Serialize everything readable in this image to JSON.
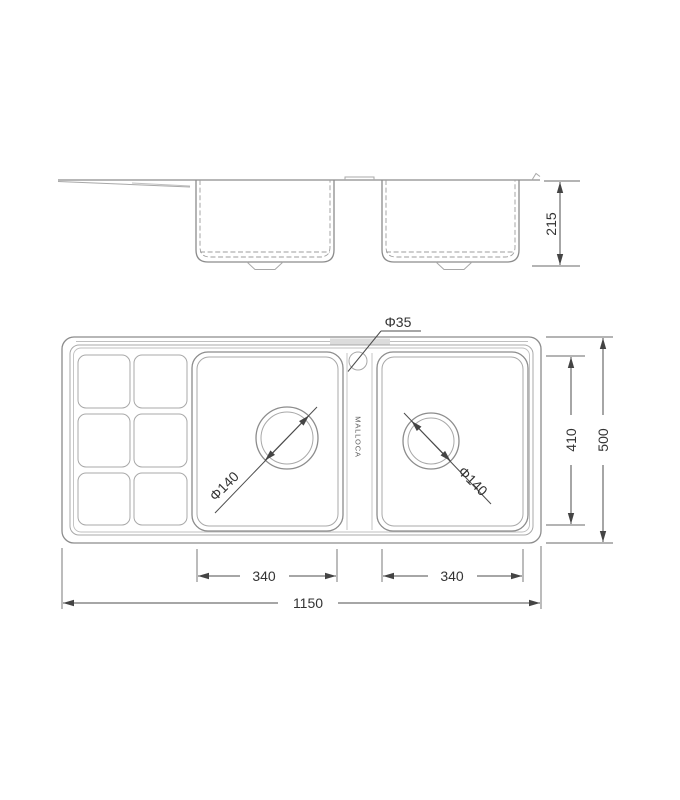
{
  "drawing": {
    "brand_label": "MALLOCA",
    "dims": {
      "bowl_depth": "215",
      "faucet_hole": "Φ35",
      "left_drain": "Φ140",
      "right_drain": "Φ140",
      "bowl_length": "410",
      "overall_depth": "500",
      "left_bowl_width": "340",
      "right_bowl_width": "340",
      "overall_length": "1150"
    }
  }
}
